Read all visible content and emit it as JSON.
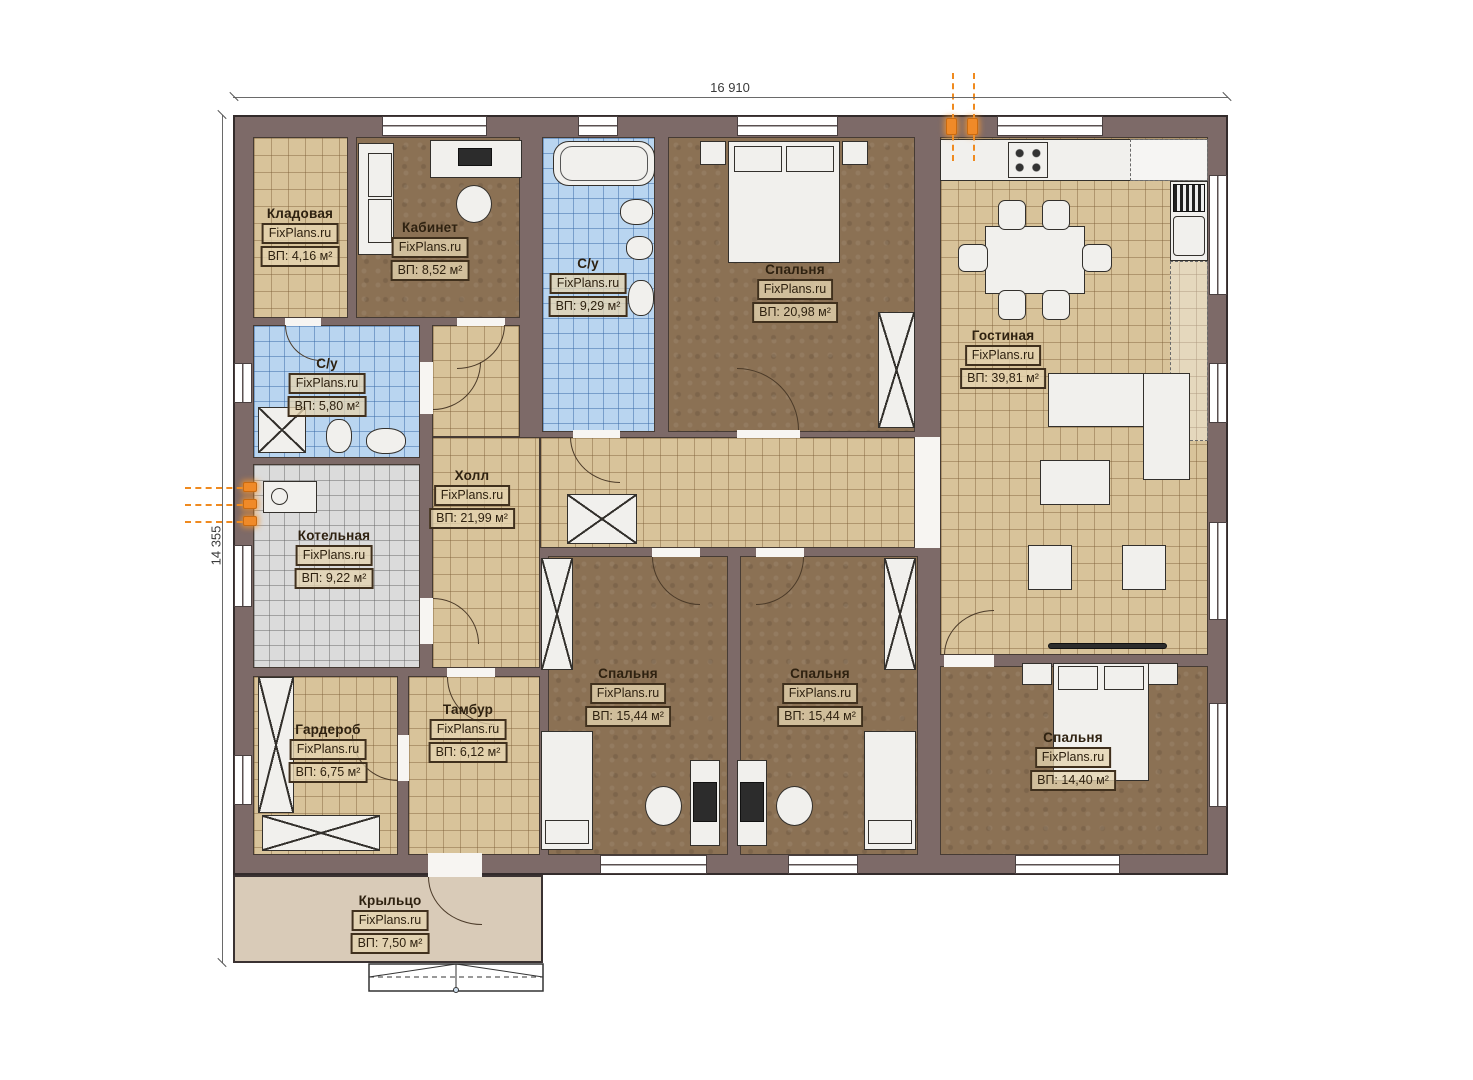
{
  "plan": {
    "width_dim": "16 910",
    "height_dim": "14 355"
  },
  "watermark": "FixPlans.ru",
  "colors": {
    "wall": "#7d6a68",
    "floor_tan": "#d8c39a",
    "floor_brown": "#8b7154",
    "floor_blue": "#b9d5f0",
    "floor_gray": "#dbdbdb",
    "porch": "#d9cbb8",
    "utility_orange": "#ef8a1f"
  },
  "rooms": [
    {
      "id": "kladovaya",
      "name": "Кладовая",
      "brand": "FixPlans.ru",
      "area": "ВП: 4,16 м²"
    },
    {
      "id": "kabinet",
      "name": "Кабинет",
      "brand": "FixPlans.ru",
      "area": "ВП: 8,52 м²"
    },
    {
      "id": "su-top",
      "name": "С/у",
      "brand": "FixPlans.ru",
      "area": "ВП: 9,29 м²"
    },
    {
      "id": "spalnya-top",
      "name": "Спальня",
      "brand": "FixPlans.ru",
      "area": "ВП: 20,98 м²"
    },
    {
      "id": "gostinaya",
      "name": "Гостиная",
      "brand": "FixPlans.ru",
      "area": "ВП: 39,81 м²"
    },
    {
      "id": "su-left",
      "name": "С/у",
      "brand": "FixPlans.ru",
      "area": "ВП: 5,80 м²"
    },
    {
      "id": "holl",
      "name": "Холл",
      "brand": "FixPlans.ru",
      "area": "ВП: 21,99 м²"
    },
    {
      "id": "kotelnaya",
      "name": "Котельная",
      "brand": "FixPlans.ru",
      "area": "ВП: 9,22 м²"
    },
    {
      "id": "garderob",
      "name": "Гардероб",
      "brand": "FixPlans.ru",
      "area": "ВП: 6,75 м²"
    },
    {
      "id": "tambur",
      "name": "Тамбур",
      "brand": "FixPlans.ru",
      "area": "ВП: 6,12 м²"
    },
    {
      "id": "spalnya-bl",
      "name": "Спальня",
      "brand": "FixPlans.ru",
      "area": "ВП: 15,44 м²"
    },
    {
      "id": "spalnya-bm",
      "name": "Спальня",
      "brand": "FixPlans.ru",
      "area": "ВП: 15,44 м²"
    },
    {
      "id": "spalnya-br",
      "name": "Спальня",
      "brand": "FixPlans.ru",
      "area": "ВП: 14,40 м²"
    },
    {
      "id": "kryltso",
      "name": "Крыльцо",
      "brand": "FixPlans.ru",
      "area": "ВП: 7,50 м²"
    }
  ]
}
